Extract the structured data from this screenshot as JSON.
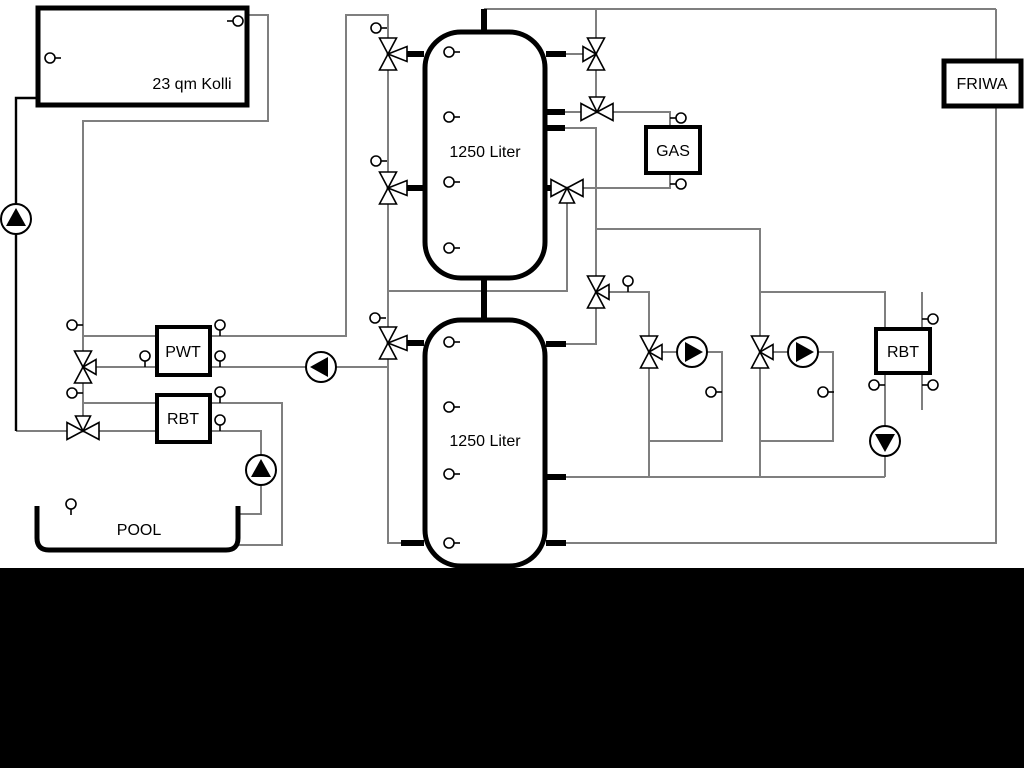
{
  "page": {
    "background": "#ffffff",
    "footer_bar_color": "#000000"
  },
  "colors": {
    "ink": "#000000",
    "pipe_line": "#7f7f7f",
    "background": "#ffffff"
  },
  "labels": {
    "collector": "23 qm Kolli",
    "upper_tank": "1250 Liter",
    "lower_tank": "1250 Liter",
    "gas_boiler": "GAS",
    "friwa": "FRIWA",
    "pwt": "PWT",
    "pool_rbt": "RBT",
    "right_rbt": "RBT",
    "pool": "POOL"
  },
  "icons": {
    "three_way_valve_icon": "two-triangle-bowtie-with-branch-triangle",
    "pump_icon": "circle-with-filled-direction-triangle",
    "temperature_sensor_icon": "small-circle-with-stem"
  }
}
